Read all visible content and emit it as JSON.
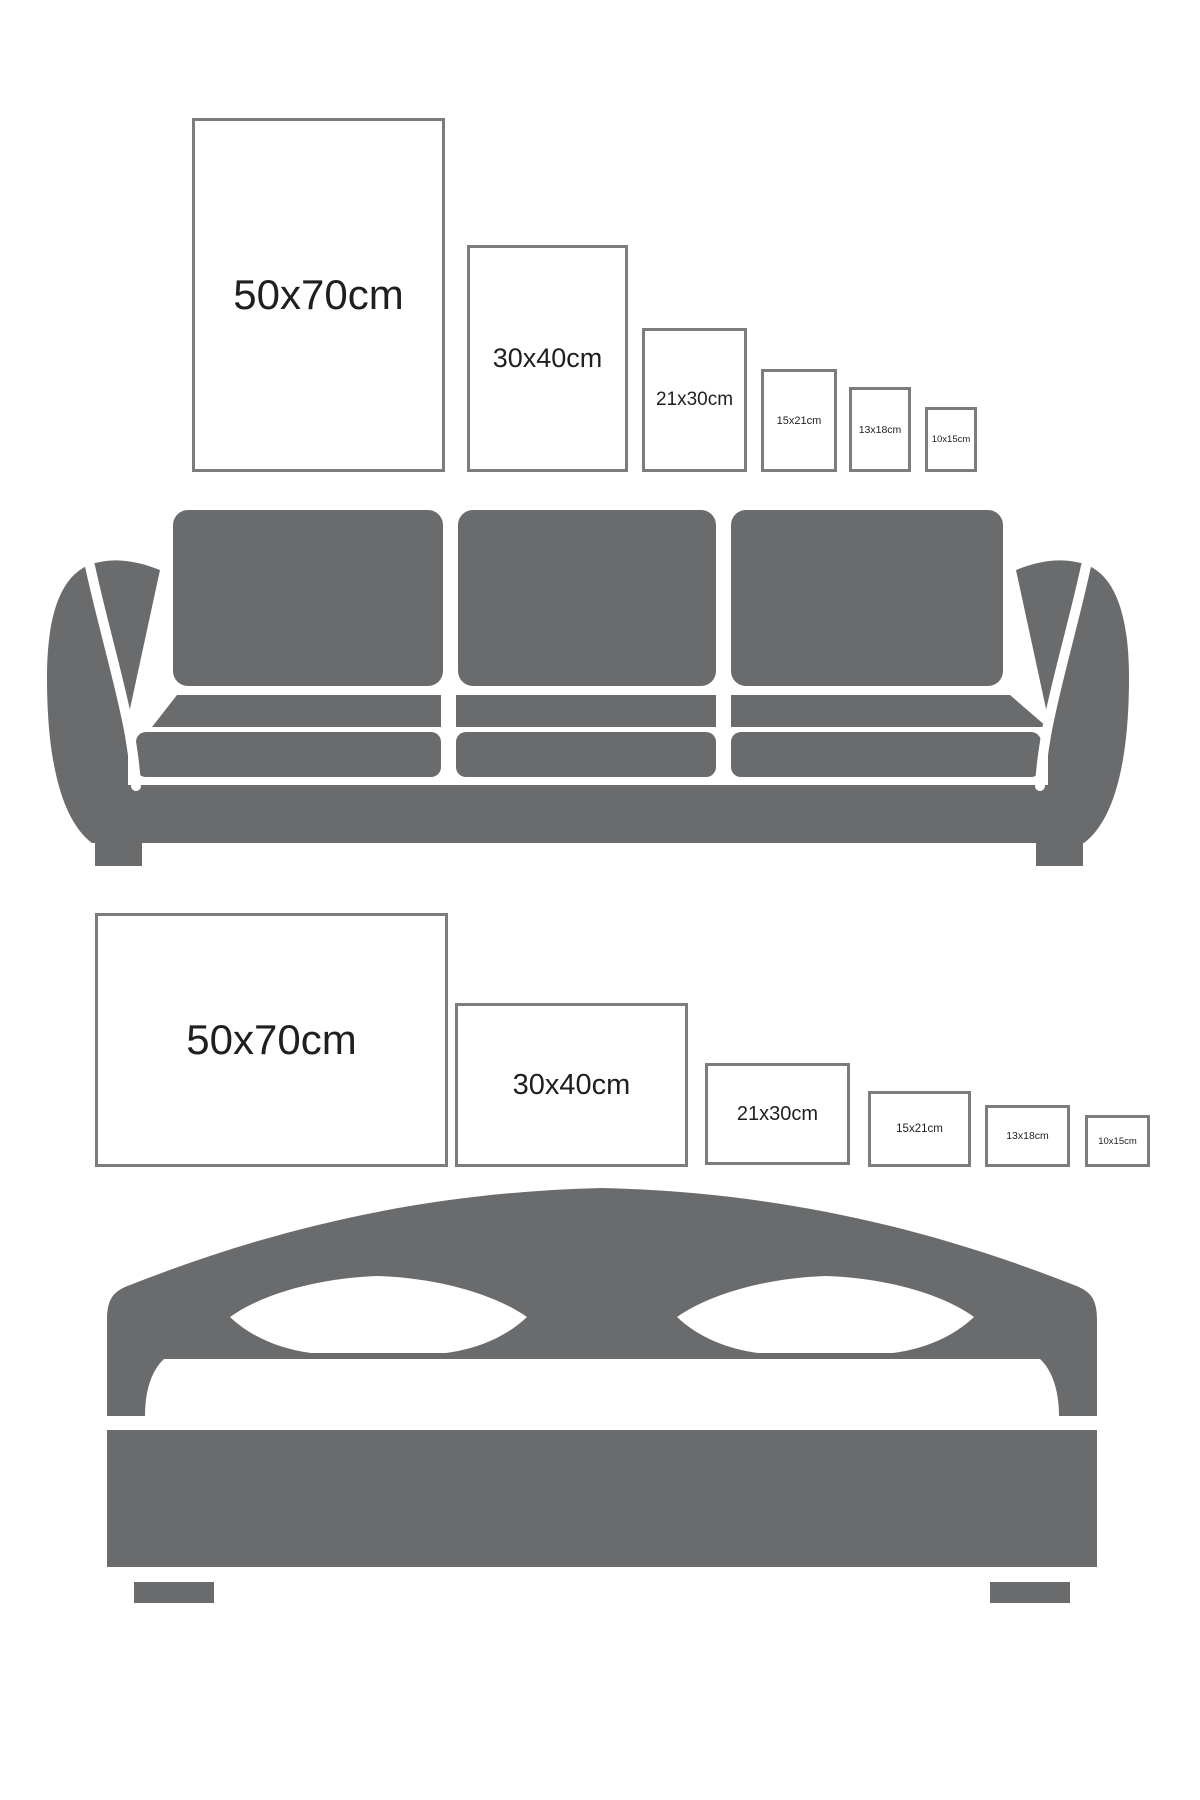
{
  "colors": {
    "furniture_gray": "#6a6b6d",
    "frame_border": "#7a7c7e",
    "label_text": "#1f1f1f",
    "background": "#ffffff"
  },
  "sections": [
    {
      "name": "poster-sizes-above-sofa",
      "furniture": "sofa",
      "frame_orientation": "portrait",
      "frames": [
        {
          "label": "50x70cm"
        },
        {
          "label": "30x40cm"
        },
        {
          "label": "21x30cm"
        },
        {
          "label": "15x21cm"
        },
        {
          "label": "13x18cm"
        },
        {
          "label": "10x15cm"
        }
      ]
    },
    {
      "name": "poster-sizes-above-bed",
      "furniture": "bed",
      "frame_orientation": "landscape",
      "frames": [
        {
          "label": "50x70cm"
        },
        {
          "label": "30x40cm"
        },
        {
          "label": "21x30cm"
        },
        {
          "label": "15x21cm"
        },
        {
          "label": "13x18cm"
        },
        {
          "label": "10x15cm"
        }
      ]
    }
  ]
}
